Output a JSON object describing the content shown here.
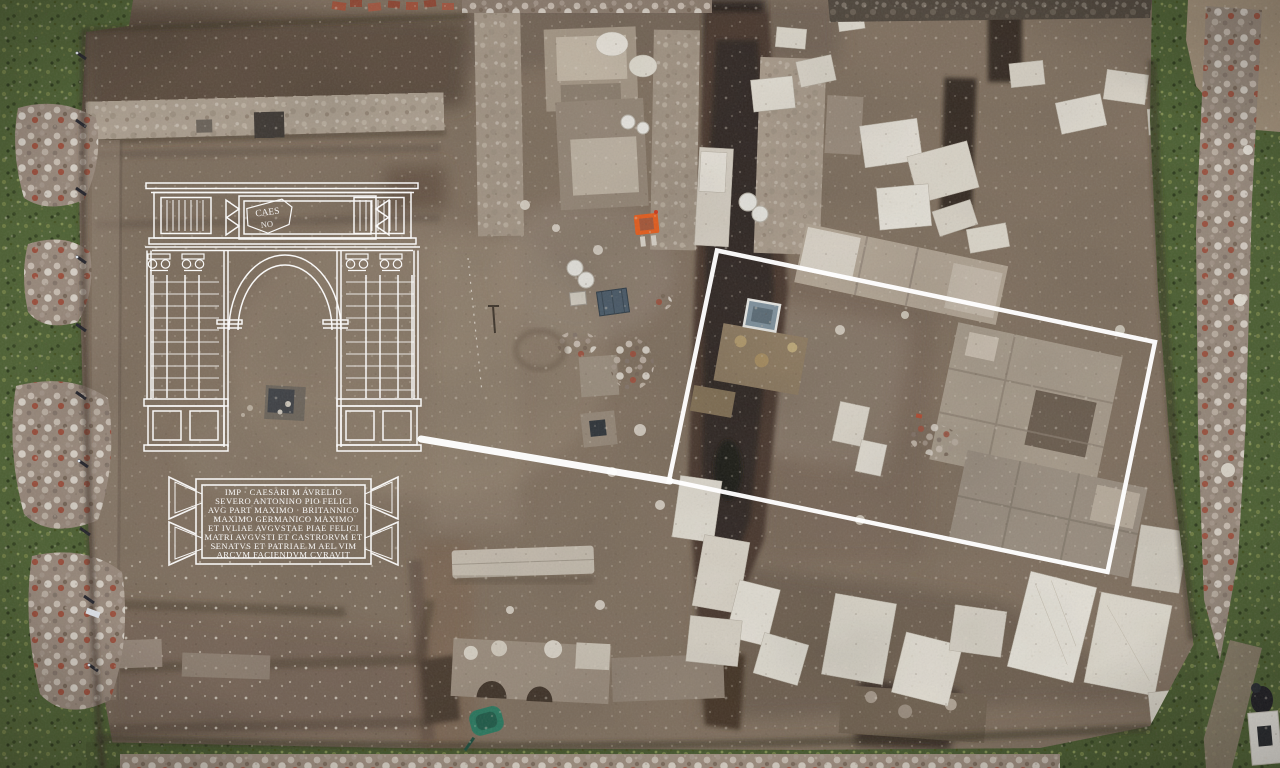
{
  "scene": {
    "title": "Aerial drone view of Roman arch excavation with reconstruction overlay",
    "site_type": "archaeological excavation trench"
  },
  "overlay": {
    "attic_fragment": {
      "top": "CAES",
      "bottom": "NO"
    },
    "inscription": {
      "lines": [
        "IMP · CAESARI M AVRELIO",
        "SEVERO ANTONINO PIO FELICI",
        "AVG PART MAXIMO · BRITANNICO",
        "MAXIMO GERMANICO MAXIMO",
        "ET IVLIAE AVGVSTAE PIAE FELICI",
        "MATRI AVGVSTI ET CASTRORVM ET",
        "SENATVS ET PATRIAE M AEL VIM",
        "ARCVM FACIENDVM CVRAVIT"
      ]
    }
  },
  "palette": {
    "overlay_white": "#ffffff",
    "dirt": "#80705f",
    "dirt_dark": "#57483c",
    "trench": "#2f2620",
    "grass": "#4e6233",
    "stone": "#a79b8b",
    "marble": "#e3ded4",
    "chair_orange": "#e95f1e",
    "crate_blue": "#4a5a68",
    "tray_blue": "#7e909c",
    "wheelbarrow_green": "#2a7a60"
  }
}
